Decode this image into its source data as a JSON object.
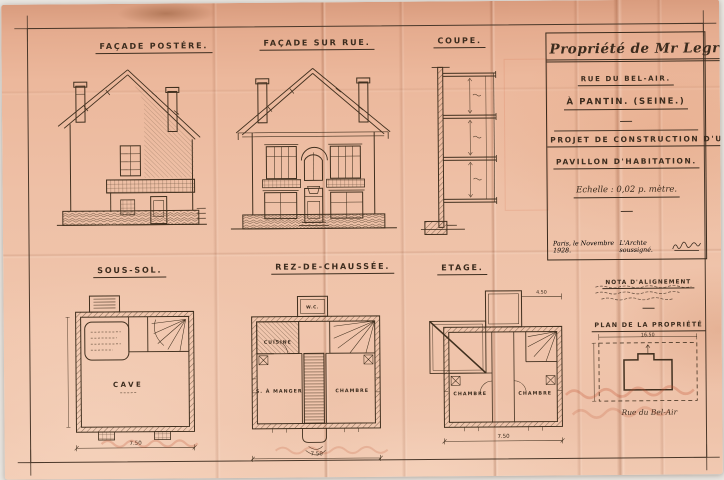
{
  "sheet": {
    "title_block": {
      "owner": "Propriété de Mr Legrand.",
      "street": "Rue du Bel-Air.",
      "city": "à Pantin. (Seine.)",
      "project_line1": "Projet de Construction d'un",
      "project_line2": "Pavillon d'Habitation.",
      "scale": "Echelle : 0,02 p. mètre.",
      "date_line": "Paris, le Novembre 1928.",
      "architect_line": "L'Archte soussigné."
    },
    "labels": {
      "facade_post": "Façade Postére.",
      "facade_rue": "Façade sur Rue.",
      "coupe": "Coupe.",
      "sous_sol": "Sous-Sol.",
      "rdc": "Rez-de-Chaussée.",
      "etage": "Etage."
    },
    "rooms": {
      "cave": "Cave",
      "cuisine": "Cuisine",
      "salle_a_manger": "S. à Manger",
      "chambre_rdc": "Chambre",
      "wc": "W.C.",
      "chambre_gauche": "Chambre",
      "chambre_droite": "Chambre"
    },
    "dims": {
      "sous_sol_width": "7.50",
      "rdc_width": "7.50",
      "etage_width": "7.50",
      "etage_annex": "4.50",
      "property_width": "16.50"
    },
    "notes": {
      "nota_heading": "Nota d'alignement",
      "property_plan_title": "Plan de la Propriété",
      "property_street": "Rue du Bel-Air"
    }
  }
}
